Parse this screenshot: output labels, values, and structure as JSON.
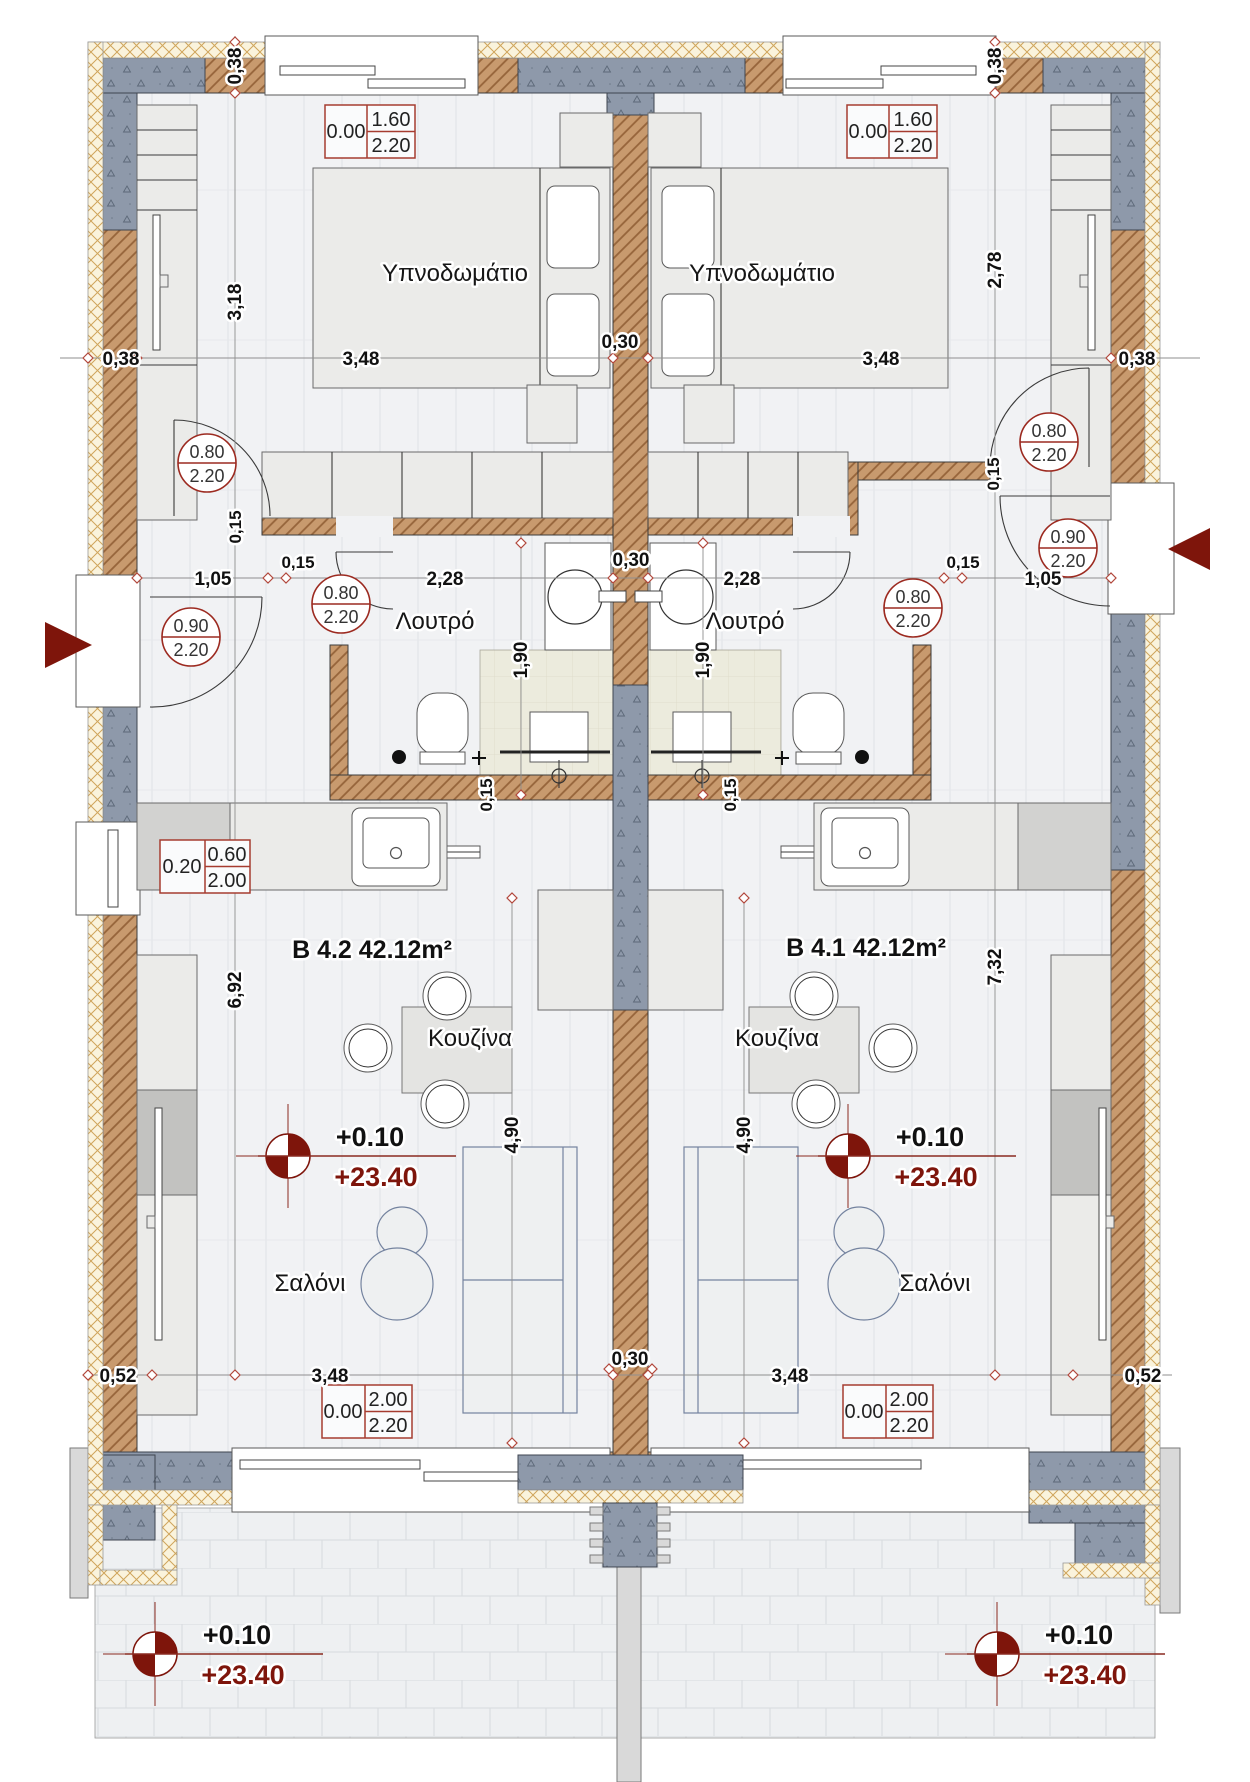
{
  "plan": {
    "units": {
      "b42": {
        "label": "B 4.2  42.12m²"
      },
      "b41": {
        "label": "B 4.1  42.12m²"
      }
    },
    "rooms": {
      "bedroom": "Υπνοδωμάτιο",
      "bathroom": "Λουτρό",
      "kitchen": "Κουζίνα",
      "living": "Σαλόνι"
    },
    "levels": {
      "floor": "+0.10",
      "absolute": "+23.40"
    },
    "openings": {
      "window_top": {
        "sill": "0.00",
        "width": "1.60",
        "height": "2.20"
      },
      "window_side": {
        "sill": "0.20",
        "width": "0.60",
        "height": "2.00"
      },
      "window_bottom": {
        "sill": "0.00",
        "width": "2.00",
        "height": "2.20"
      },
      "door_interior": {
        "width": "0.80",
        "height": "2.20"
      },
      "door_entry": {
        "width": "0.90",
        "height": "2.20"
      }
    },
    "dims": {
      "d038": "0,38",
      "d348": "3,48",
      "d030": "0,30",
      "d318": "3,18",
      "d278": "2,78",
      "d105": "1,05",
      "d015": "0,15",
      "d228": "2,28",
      "d190": "1,90",
      "d692": "6,92",
      "d732": "7,32",
      "d490": "4,90",
      "d052": "0,52"
    },
    "colors": {
      "wall_brown": "#c89a6e",
      "concrete_gray": "#8e99aa",
      "insulation_cream": "#faf3dc",
      "accent_red": "#7e150b",
      "schedule_red": "#a63c30",
      "floor_gray": "#f1f2f4"
    }
  }
}
